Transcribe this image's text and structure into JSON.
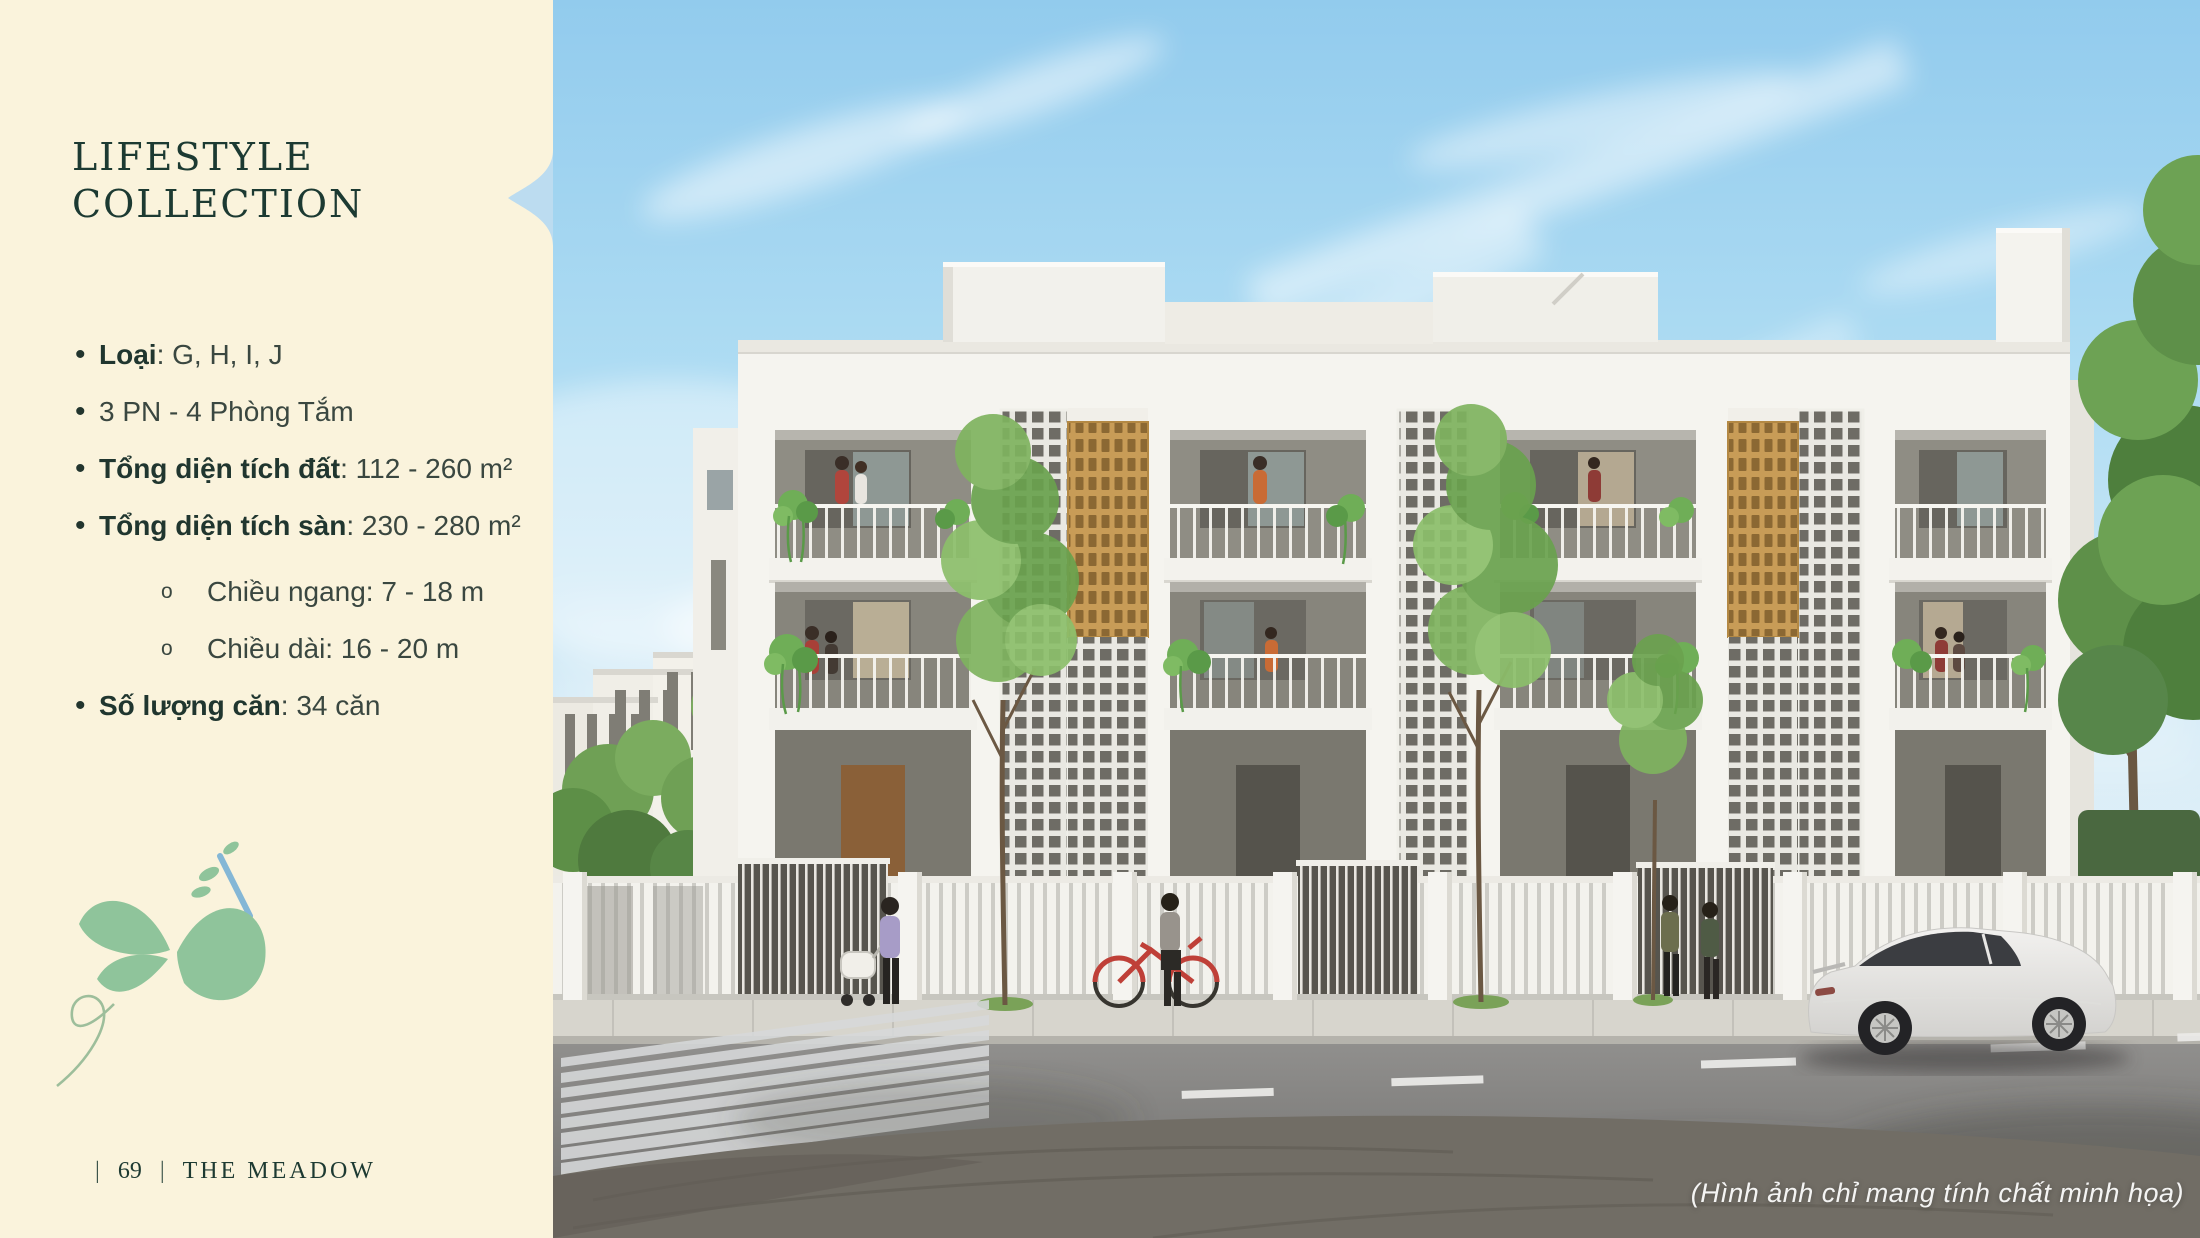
{
  "panel": {
    "title": {
      "line1": "LIFESTYLE",
      "line2": "COLLECTION"
    },
    "items": [
      {
        "marker": "•",
        "label": "Loại",
        "value": ": G, H, I, J"
      },
      {
        "marker": "•",
        "label": "",
        "value": "3 PN - 4 Phòng Tắm"
      },
      {
        "marker": "•",
        "label": "Tổng diện tích đất",
        "value": ": 112 - 260 m²"
      },
      {
        "marker": "•",
        "label": "Tổng diện tích sàn",
        "value": ": 230 - 280 m²"
      },
      {
        "marker": "o",
        "label": "",
        "value": "Chiều ngang: 7 - 18 m"
      },
      {
        "marker": "o",
        "label": "",
        "value": "Chiều dài: 16 - 20 m"
      },
      {
        "marker": "•",
        "label": "Số lượng căn",
        "value": ": 34 căn"
      }
    ],
    "footer": {
      "divider": "|",
      "page": "69",
      "project": "THE MEADOW"
    }
  },
  "photo": {
    "caption": "(Hình ảnh chỉ mang tính chất minh họa)"
  },
  "colors": {
    "panel_bg": "#FAF3DC",
    "brand_green": "#1C3A32",
    "body_text": "#3A4740",
    "logo_green": "#8FC49B",
    "logo_blue": "#84B7D6",
    "accent_gold": "#C89C57",
    "sky_blue": "#9ED4F0"
  }
}
